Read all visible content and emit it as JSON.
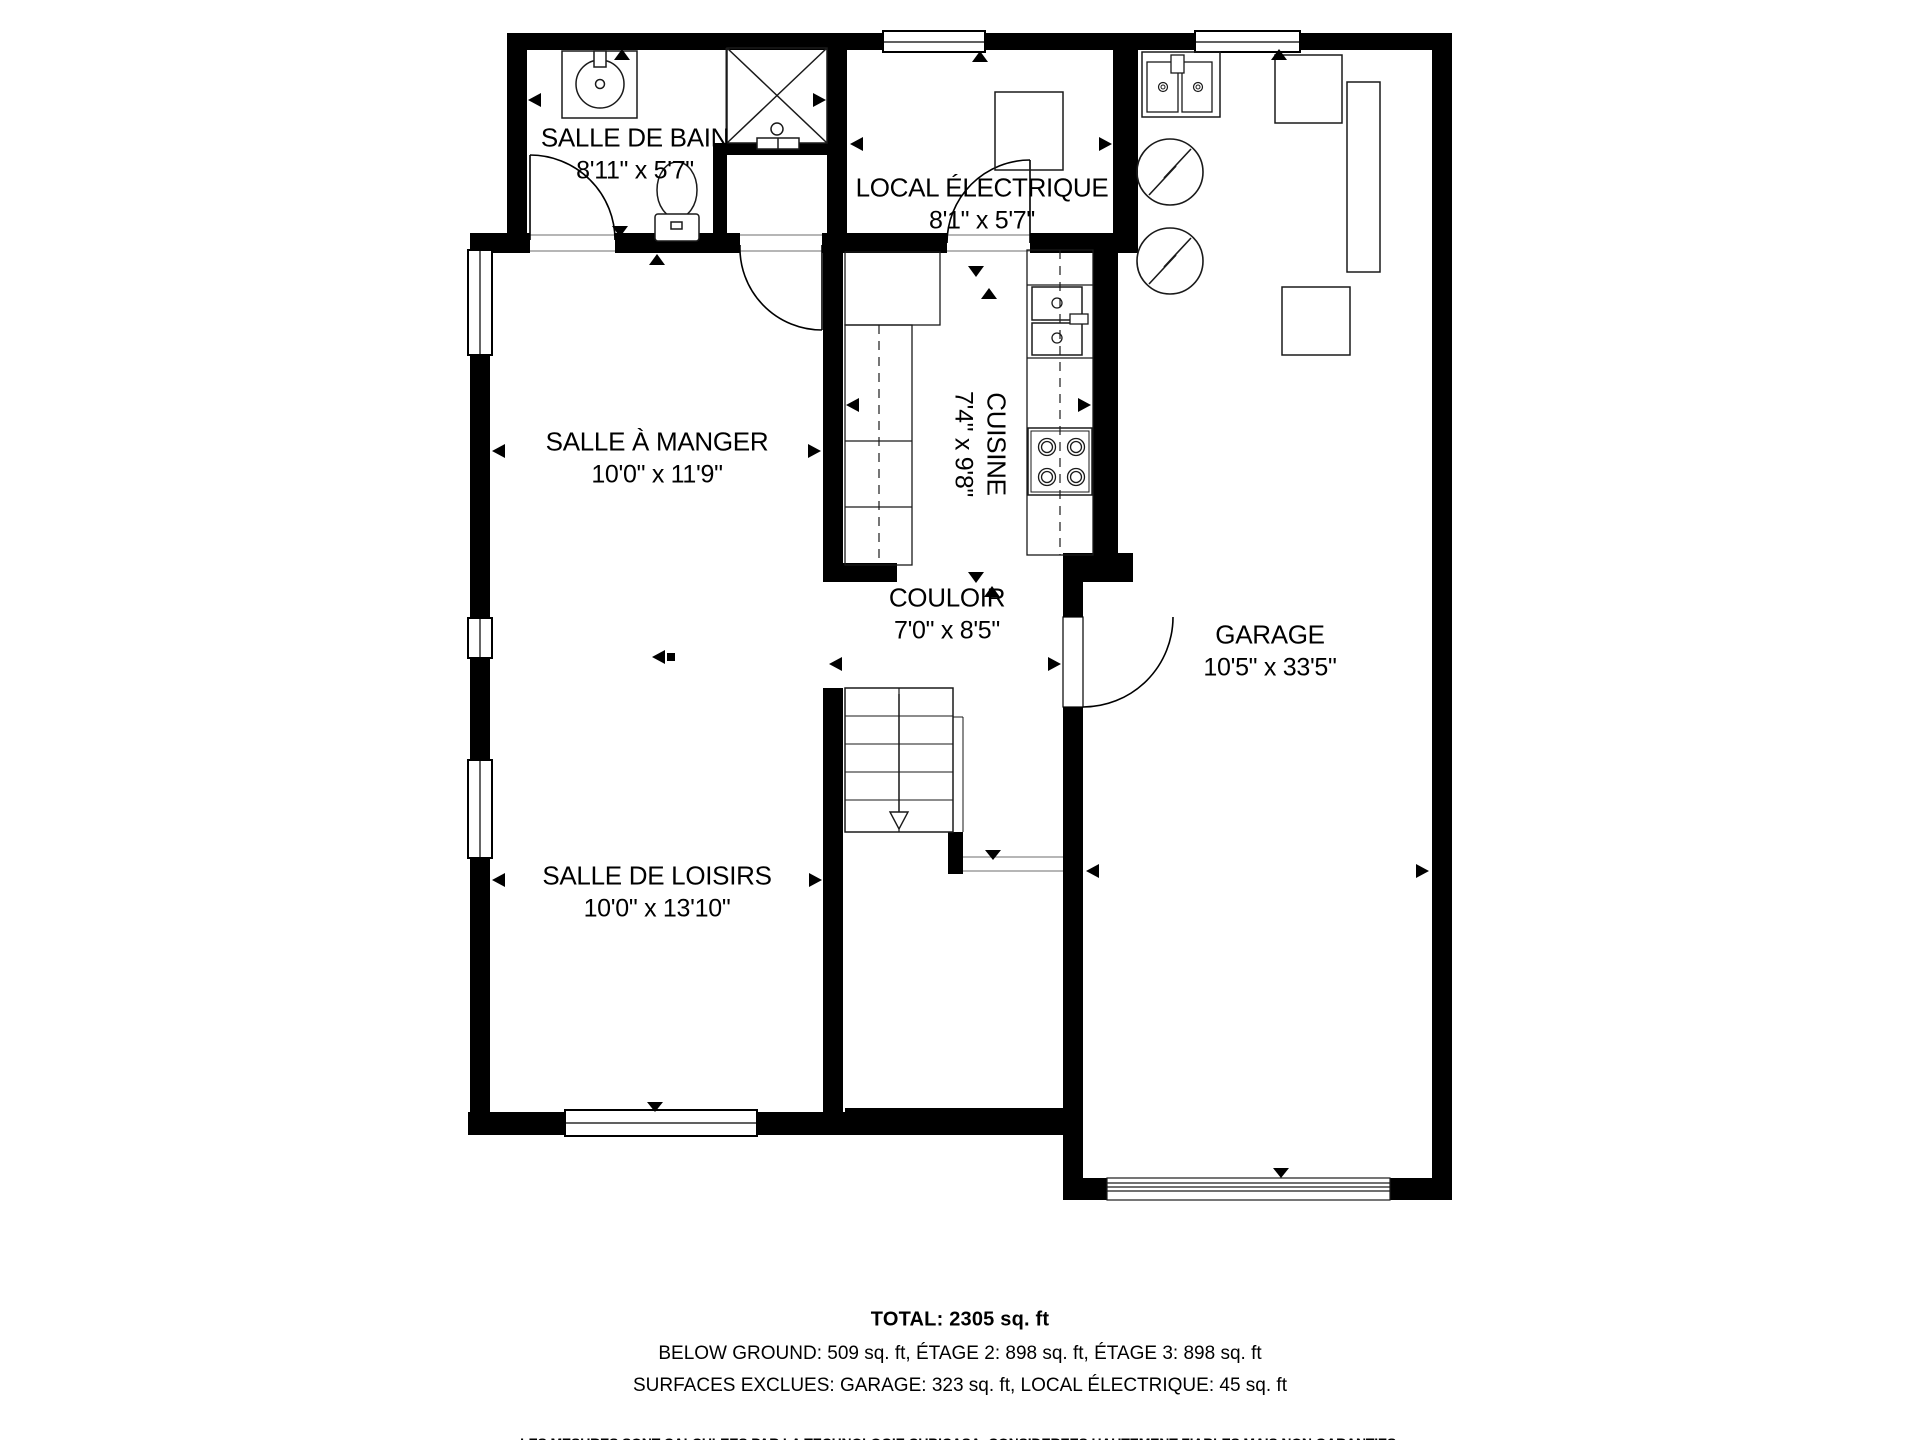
{
  "plan": {
    "rooms": [
      {
        "id": "salle-de-bain",
        "name": "SALLE DE BAIN",
        "dims": "8'11\" x 5'7\""
      },
      {
        "id": "local-electrique",
        "name": "LOCAL ÉLECTRIQUE",
        "dims": "8'1\" x 5'7\""
      },
      {
        "id": "salle-a-manger",
        "name": "SALLE À MANGER",
        "dims": "10'0\" x 11'9\""
      },
      {
        "id": "cuisine",
        "name": "CUISINE",
        "dims": "7'4\" x 9'8\""
      },
      {
        "id": "couloir",
        "name": "COULOIR",
        "dims": "7'0\" x 8'5\""
      },
      {
        "id": "garage",
        "name": "GARAGE",
        "dims": "10'5\" x 33'5\""
      },
      {
        "id": "salle-de-loisirs",
        "name": "SALLE DE LOISIRS",
        "dims": "10'0\" x 13'10\""
      }
    ],
    "fixtures": [
      "bathroom-sink",
      "shower",
      "toilet",
      "electrical-panel",
      "refrigerator",
      "kitchen-counter",
      "kitchen-sink",
      "stove",
      "staircase",
      "laundry-sink",
      "water-heater",
      "water-heater",
      "garage-door"
    ],
    "colors": {
      "wall": "#000000",
      "background": "#ffffff",
      "text": "#000000",
      "fixture_line": "#1a1a1a"
    }
  },
  "summary": {
    "total": "TOTAL: 2305 sq. ft",
    "levels": "BELOW GROUND: 509 sq. ft, ÉTAGE 2: 898 sq. ft, ÉTAGE 3: 898 sq. ft",
    "excluded": "SURFACES EXCLUES: GARAGE: 323 sq. ft, LOCAL ÉLECTRIQUE: 45 sq. ft",
    "disclaimer": "LES MESURES SONT CALCULEES PAR LA TECHNOLOGIE CUBICASA. CONSIDEREES HAUTEMENT FIABLES MAIS NON GARANTIES."
  }
}
